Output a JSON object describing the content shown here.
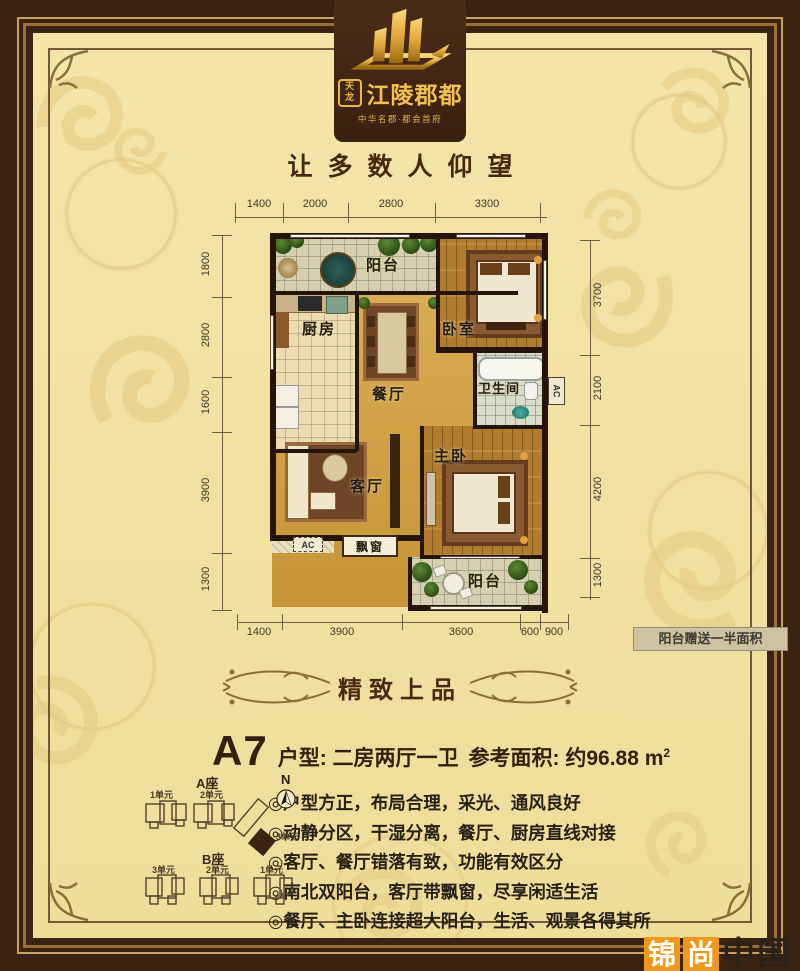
{
  "logo": {
    "seal_top": "天",
    "seal_bottom": "龙",
    "title": "江陵郡都",
    "subtitle": "中华名郡·都会首府"
  },
  "slogan": "让多数人仰望",
  "plan": {
    "dims": {
      "top": [
        "1400",
        "2000",
        "2800",
        "3300"
      ],
      "left": [
        "1800",
        "2800",
        "1600",
        "3900",
        "1300"
      ],
      "right": [
        "3700",
        "2100",
        "4200",
        "1300"
      ],
      "bottom": [
        "1400",
        "3900",
        "3600",
        "600",
        "900"
      ]
    },
    "rooms": {
      "balcony_top": "阳台",
      "bedroom": "卧室",
      "kitchen": "厨房",
      "dining": "餐厅",
      "bathroom": "卫生间",
      "living": "客厅",
      "master": "主卧",
      "bay_window": "飘窗",
      "balcony_bottom": "阳台",
      "ac_right": "AC",
      "ac_left": "AC"
    },
    "note": "阳台赠送一半面积"
  },
  "badge": "精致上品",
  "details": {
    "unit_label": "A7",
    "unit_type": "户型: 二房两厅一卫",
    "area_label": "参考面积: 约96.88 m",
    "area_sup": "2"
  },
  "features": [
    "◎户型方正，布局合理，采光、通风良好",
    "◎动静分区，干湿分离，餐厅、厨房直线对接",
    "◎客厅、餐厅错落有致，功能有效区分",
    "◎南北双阳台，客厅带飘窗，尽享闲适生活",
    "◎餐厅、主卧连接超大阳台，生活、观景各得其所"
  ],
  "siteplan": {
    "block_a": "A座",
    "block_b": "B座",
    "units_a": [
      "1单元",
      "2单元",
      "3单元"
    ],
    "units_b": [
      "3单元",
      "2单元",
      "1单元"
    ],
    "compass": "N"
  },
  "watermark": {
    "char1": "锦",
    "char2": "尚",
    "suffix": "中国"
  },
  "colors": {
    "frame": "#3b2313",
    "background": "#f2e2a2",
    "gold_line": "#c9a25c",
    "logo_gold": "#f0c153",
    "floor_gold": "#d6a54a",
    "wall": "#241409",
    "accent_orange": "#ef981b"
  }
}
